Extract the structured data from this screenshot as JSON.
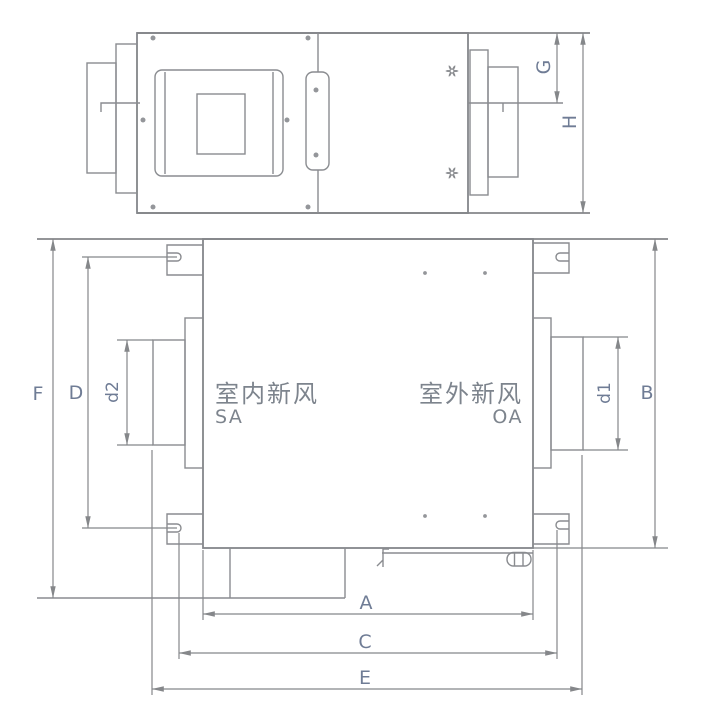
{
  "drawing": {
    "type": "technical-dimension-diagram",
    "subject": "heat-recovery-ventilator-unit",
    "side_view": {
      "dim_labels": {
        "G": "G",
        "H": "H"
      }
    },
    "plan_view": {
      "dim_labels": {
        "F": "F",
        "D": "D",
        "d2": "d2",
        "B": "B",
        "d1": "d1",
        "A": "A",
        "C": "C",
        "E": "E"
      },
      "ports": {
        "supply_name": "室内新风",
        "supply_code": "SA",
        "outdoor_name": "室外新风",
        "outdoor_code": "OA"
      }
    },
    "colors": {
      "background": "#ffffff",
      "outline": "#84868a",
      "dimension_line": "#85878a",
      "dimension_text": "#6f7c95",
      "port_text": "#7d848d"
    }
  }
}
